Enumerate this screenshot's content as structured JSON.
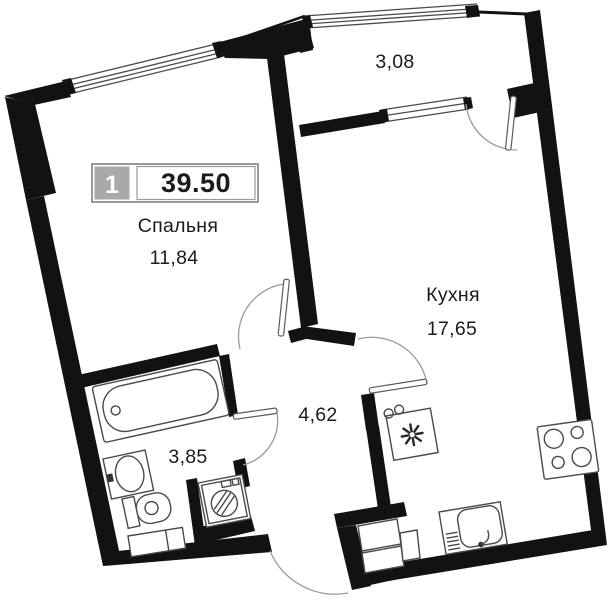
{
  "plan": {
    "apartment_number": "1",
    "total_area": "39.50",
    "rooms": {
      "bedroom": {
        "name": "Спальня",
        "area": "11,84"
      },
      "kitchen": {
        "name": "Кухня",
        "area": "17,65"
      },
      "hallway": {
        "area": "4,62"
      },
      "bathroom": {
        "area": "3,85"
      },
      "balcony": {
        "area": "3,08"
      }
    },
    "fixtures": [
      "bathtub",
      "washbasin",
      "toilet",
      "bath-cabinet",
      "washing-machine",
      "fridge",
      "kitchen-sink",
      "stove",
      "vent-shaft"
    ],
    "colors": {
      "wall": "#121212",
      "fixture_line": "#4a4a4a",
      "label_cell_gray": "#a9a9a9",
      "background": "#ffffff"
    }
  }
}
